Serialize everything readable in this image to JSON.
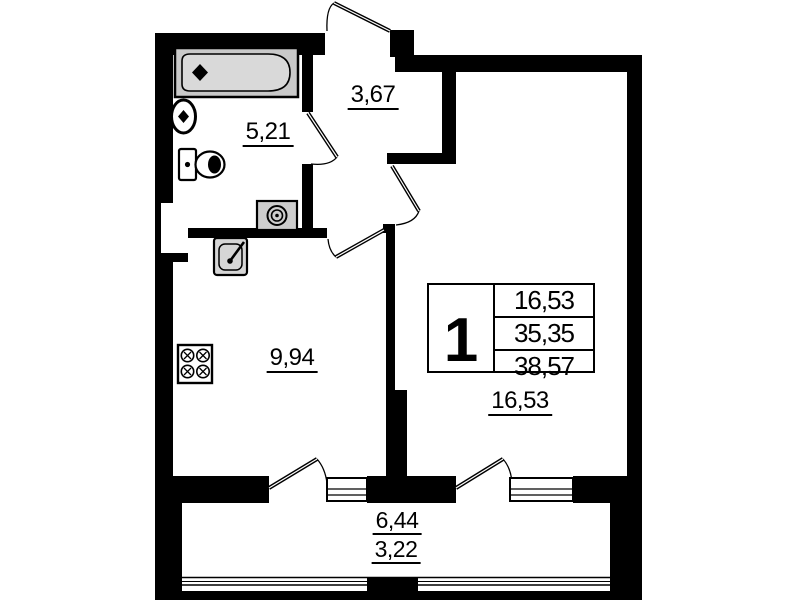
{
  "legend": {
    "apartment_number": "1",
    "rows": [
      "16,53",
      "35,35",
      "38,57"
    ]
  },
  "rooms": {
    "bathroom": {
      "area": "5,21"
    },
    "hallway": {
      "area": "3,67"
    },
    "kitchen": {
      "area": "9,94"
    },
    "living_room": {
      "area": "16,53"
    },
    "balcony": {
      "area_total": "6,44",
      "area_reduced": "3,22"
    }
  },
  "icons": {
    "bathtub": "bathtub-icon",
    "wash_basin": "wash-basin-icon",
    "toilet": "toilet-icon",
    "washing_machine": "washing-machine-icon",
    "kitchen_sink": "kitchen-sink-icon",
    "stove": "stove-icon",
    "door_swing": "door-swing-icon",
    "window": "window-icon",
    "balcony_glazing": "balcony-glazing-icon"
  },
  "colors": {
    "wall": "#000000",
    "background": "#ffffff",
    "fixture_fill": "#cdcdcd",
    "tub_fill": "#d9d9d9"
  }
}
